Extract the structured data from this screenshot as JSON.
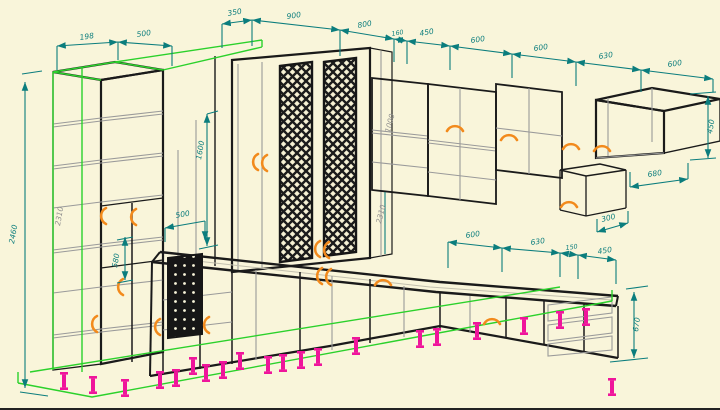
{
  "canvas": {
    "width": 720,
    "height": 408,
    "background_color": "#f9f5da"
  },
  "palette": {
    "cabinet_outline": "#1a1a1a",
    "secondary_lines": "#9a9a9a",
    "dimension_color": "#0b7d7d",
    "selection_highlight": "#2bd12b",
    "door_swing_marker": "#f28a1c",
    "cabinet_feet": "#ef159b",
    "gray_dimension_text": "#8f8f8f"
  },
  "icons": {
    "door_swing": "orange quarter-arc",
    "cabinet_foot": "magenta flanged peg",
    "lattice_door": "diamond cross-hatch panel",
    "wire_basket": "black panel with dot grid"
  },
  "dims": [
    {
      "v": "198"
    },
    {
      "v": "500"
    },
    {
      "v": "350"
    },
    {
      "v": "900"
    },
    {
      "v": "800"
    },
    {
      "v": "160"
    },
    {
      "v": "450"
    },
    {
      "v": "600"
    },
    {
      "v": "600"
    },
    {
      "v": "630"
    },
    {
      "v": "600"
    },
    {
      "v": "450"
    },
    {
      "v": "680"
    },
    {
      "v": "300"
    },
    {
      "v": "2460"
    },
    {
      "v": "2310"
    },
    {
      "v": "1600"
    },
    {
      "v": "500"
    },
    {
      "v": "580"
    },
    {
      "v": "1000"
    },
    {
      "v": "2310"
    },
    {
      "v": "600"
    },
    {
      "v": "630"
    },
    {
      "v": "150"
    },
    {
      "v": "450"
    },
    {
      "v": "670"
    }
  ]
}
